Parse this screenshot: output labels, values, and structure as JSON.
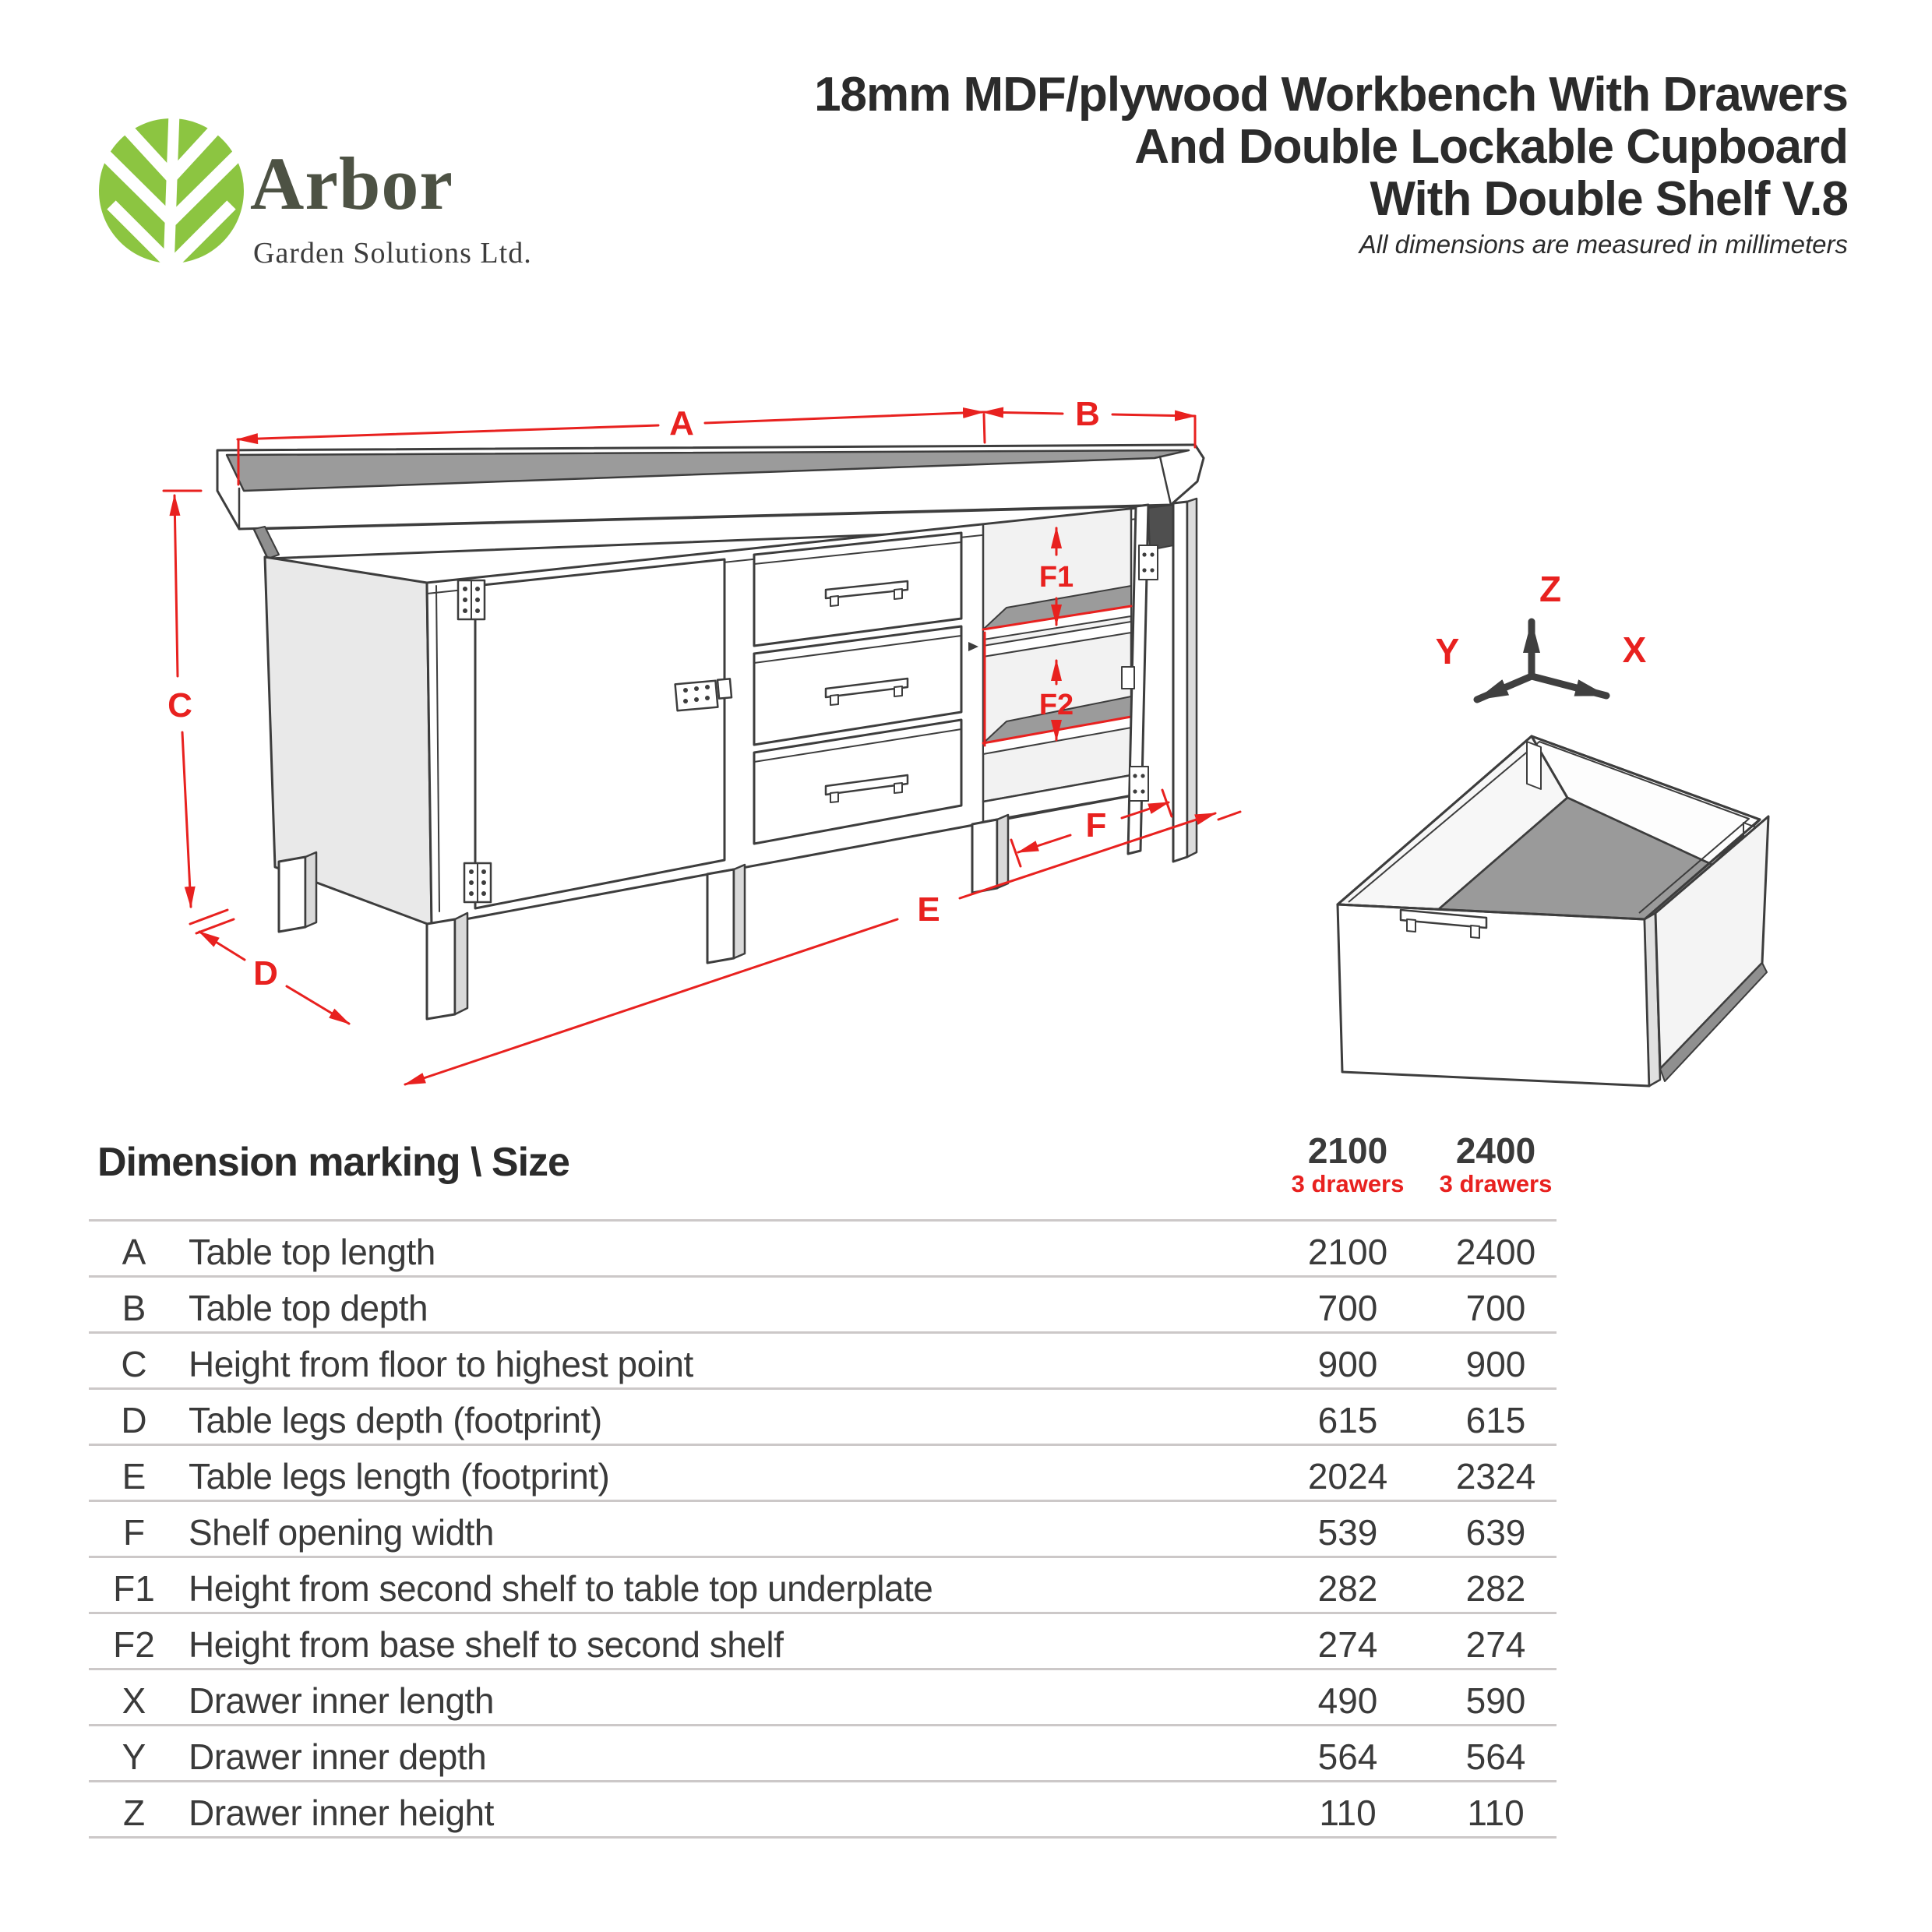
{
  "logo": {
    "brand": "Arbor",
    "tagline": "Garden Solutions Ltd."
  },
  "header": {
    "title_line1": "18mm MDF/plywood Workbench With Drawers",
    "title_line2": "And Double Lockable Cupboard",
    "title_line3": "With Double Shelf V.8",
    "subtitle": "All dimensions are measured in millimeters"
  },
  "diagram": {
    "markers": {
      "A": "A",
      "B": "B",
      "C": "C",
      "D": "D",
      "E": "E",
      "F": "F",
      "F1": "F1",
      "F2": "F2"
    },
    "axes": {
      "x": "X",
      "y": "Y",
      "z": "Z"
    }
  },
  "table": {
    "corner_header": "Dimension marking \\ Size",
    "columns": [
      {
        "size": "2100",
        "variant": "3 drawers"
      },
      {
        "size": "2400",
        "variant": "3 drawers"
      }
    ],
    "rows": [
      {
        "mark": "A",
        "desc": "Table top length",
        "v2100": "2100",
        "v2400": "2400"
      },
      {
        "mark": "B",
        "desc": "Table top depth",
        "v2100": "700",
        "v2400": "700"
      },
      {
        "mark": "C",
        "desc": "Height from floor to highest point",
        "v2100": "900",
        "v2400": "900"
      },
      {
        "mark": "D",
        "desc": "Table legs depth (footprint)",
        "v2100": "615",
        "v2400": "615"
      },
      {
        "mark": "E",
        "desc": "Table legs length (footprint)",
        "v2100": "2024",
        "v2400": "2324"
      },
      {
        "mark": "F",
        "desc": "Shelf opening width",
        "v2100": "539",
        "v2400": "639"
      },
      {
        "mark": "F1",
        "desc": "Height from second shelf to table top underplate",
        "v2100": "282",
        "v2400": "282"
      },
      {
        "mark": "F2",
        "desc": "Height from base shelf to second shelf",
        "v2100": "274",
        "v2400": "274"
      },
      {
        "mark": "X",
        "desc": "Drawer inner length",
        "v2100": "490",
        "v2400": "590"
      },
      {
        "mark": "Y",
        "desc": "Drawer inner depth",
        "v2100": "564",
        "v2400": "564"
      },
      {
        "mark": "Z",
        "desc": "Drawer inner height",
        "v2100": "110",
        "v2400": "110"
      }
    ]
  },
  "colors": {
    "accent_red": "#e8211f",
    "leaf_green": "#8cc541",
    "ink": "#3d3d3d",
    "surface_gray": "#9b9b9b"
  }
}
